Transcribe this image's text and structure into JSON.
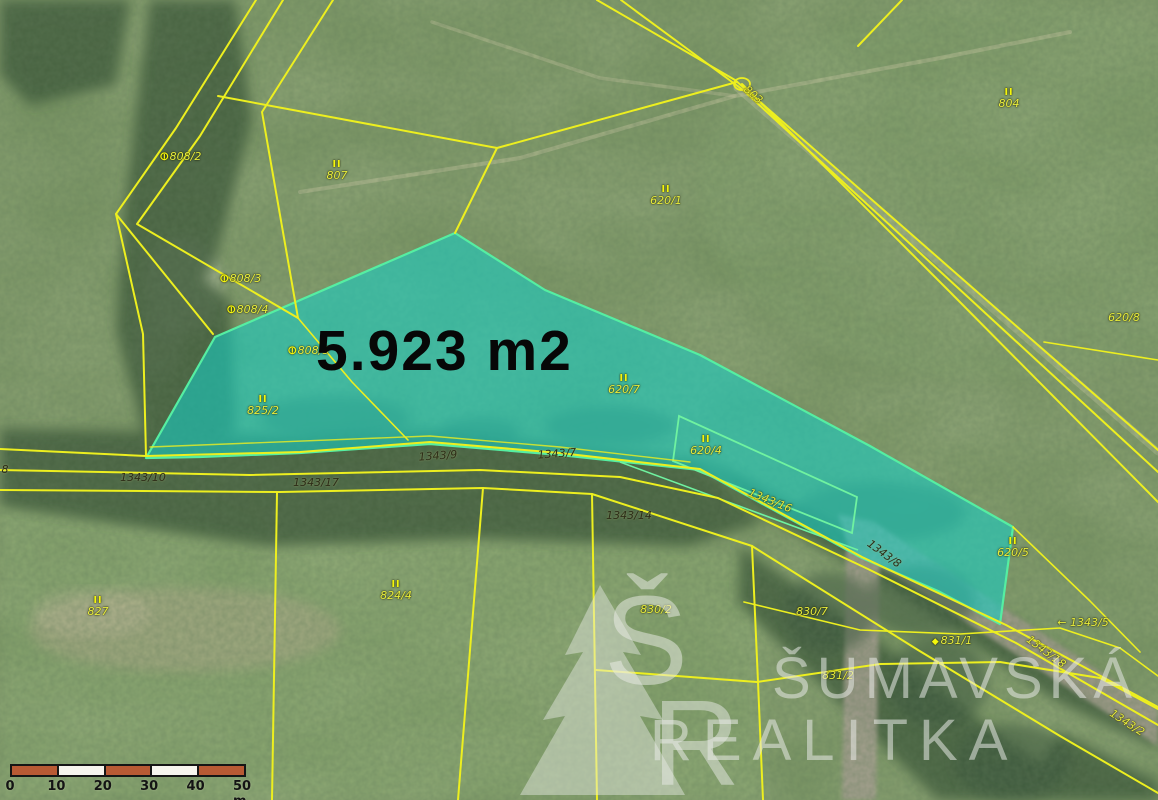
{
  "map": {
    "area_label": "5.923 m2",
    "highlight_color": "#17cfc4",
    "boundary_color": "#edef1f",
    "parcels": [
      {
        "t": "808/2",
        "x": 180,
        "y": 157,
        "sym": "theta"
      },
      {
        "t": "807",
        "x": 337,
        "y": 171,
        "sym": "II"
      },
      {
        "t": "620/1",
        "x": 666,
        "y": 196,
        "sym": "II"
      },
      {
        "t": "804",
        "x": 1009,
        "y": 99,
        "sym": "II"
      },
      {
        "t": "803",
        "x": 753,
        "y": 95,
        "rot": 41
      },
      {
        "t": "620/8",
        "x": 1124,
        "y": 318
      },
      {
        "t": "808/3",
        "x": 240,
        "y": 279,
        "sym": "theta"
      },
      {
        "t": "808/4",
        "x": 247,
        "y": 310,
        "sym": "theta"
      },
      {
        "t": "808/5",
        "x": 308,
        "y": 351,
        "sym": "theta"
      },
      {
        "t": "825/2",
        "x": 263,
        "y": 406,
        "sym": "II"
      },
      {
        "t": "620/7",
        "x": 624,
        "y": 385,
        "sym": "II"
      },
      {
        "t": "620/4",
        "x": 706,
        "y": 446,
        "sym": "II"
      },
      {
        "t": "1343/16",
        "x": 770,
        "y": 501,
        "rot": 22
      },
      {
        "t": "620/5",
        "x": 1013,
        "y": 548,
        "sym": "II"
      },
      {
        "t": "1343/5",
        "x": 1083,
        "y": 623,
        "prefix": "← "
      },
      {
        "t": "1343/18",
        "x": 1046,
        "y": 652,
        "rot": 37
      },
      {
        "t": "1343/2",
        "x": 1127,
        "y": 723,
        "rot": 33
      },
      {
        "t": "831/1",
        "x": 952,
        "y": 641,
        "sym": "diamond",
        "symPos": "left"
      },
      {
        "t": "831/2",
        "x": 838,
        "y": 676
      },
      {
        "t": "830/7",
        "x": 812,
        "y": 612
      },
      {
        "t": "830/2",
        "x": 656,
        "y": 610
      },
      {
        "t": "824/4",
        "x": 396,
        "y": 591,
        "sym": "II"
      },
      {
        "t": "827",
        "x": 98,
        "y": 607,
        "sym": "II"
      },
      {
        "t": "1343/10",
        "x": 143,
        "y": 478,
        "dark": true
      },
      {
        "t": "1343/17",
        "x": 316,
        "y": 483,
        "dark": true
      },
      {
        "t": "1343/9",
        "x": 438,
        "y": 456,
        "dark": true,
        "rot": -4
      },
      {
        "t": "1343/7",
        "x": 557,
        "y": 454,
        "dark": true,
        "rot": -4
      },
      {
        "t": "1343/14",
        "x": 629,
        "y": 516,
        "dark": true
      },
      {
        "t": "1343/8",
        "x": 884,
        "y": 554,
        "dark": true,
        "rot": 36
      },
      {
        "t": "8",
        "x": 5,
        "y": 470,
        "dark": true
      }
    ]
  },
  "watermark": {
    "monogram_top": "Š",
    "monogram_bottom": "R",
    "line1": "ŠUMAVSKÁ",
    "line2": "REALITKA"
  },
  "scale_bar": {
    "unit_labels": [
      "0",
      "10",
      "20",
      "30",
      "40",
      "50 m"
    ],
    "segment_colors": [
      "#b85a34",
      "#f7f5ee",
      "#b85a34",
      "#f7f5ee",
      "#b85a34"
    ]
  }
}
